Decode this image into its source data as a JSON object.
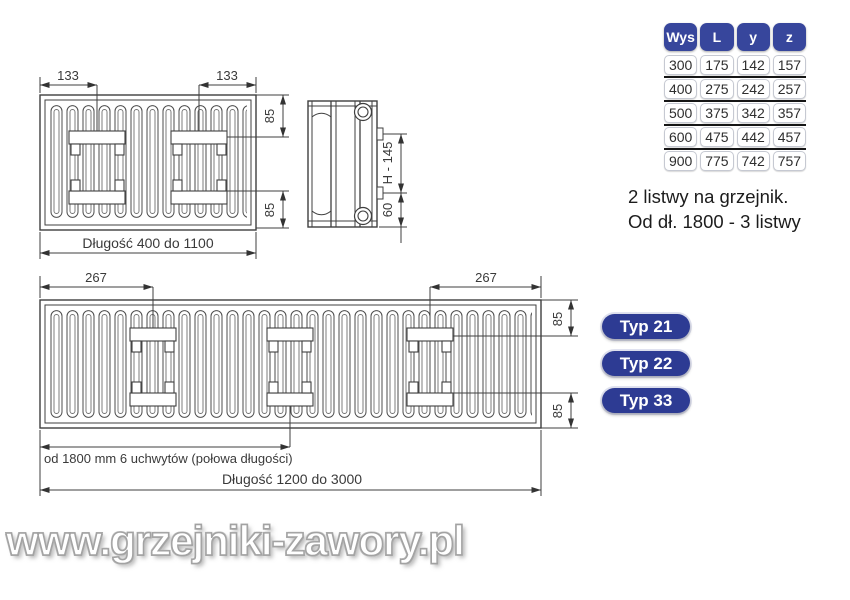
{
  "spec_table": {
    "headers": [
      "Wys",
      "L",
      "y",
      "z"
    ],
    "rows": [
      [
        "300",
        "175",
        "142",
        "157"
      ],
      [
        "400",
        "275",
        "242",
        "257"
      ],
      [
        "500",
        "375",
        "342",
        "357"
      ],
      [
        "600",
        "475",
        "442",
        "457"
      ],
      [
        "900",
        "775",
        "742",
        "757"
      ]
    ]
  },
  "note": {
    "line1": "2 listwy na grzejnik.",
    "line2": "Od dł. 1800 - 3 listwy"
  },
  "type_buttons": [
    {
      "label": "Typ 21"
    },
    {
      "label": "Typ 22"
    },
    {
      "label": "Typ 33"
    }
  ],
  "small_radiator": {
    "left_offset": "133",
    "right_offset": "133",
    "top_margin": "85",
    "bottom_margin": "85",
    "length": "Długość 400 do 1100"
  },
  "side_view": {
    "height": "H - 145",
    "bottom": "60"
  },
  "large_radiator": {
    "left_offset": "267",
    "right_offset": "267",
    "top_margin": "85",
    "bottom_margin": "85",
    "brackets_note": "od 1800 mm 6 uchwytów (połowa długości)",
    "length": "Długość 1200 do 3000"
  },
  "watermark": {
    "text": "www.grzejniki-zawory.pl"
  },
  "colors": {
    "table_header_blue": "#37469c",
    "type_button_blue": "#2d3b93",
    "line_color": "#3a3a3a"
  }
}
